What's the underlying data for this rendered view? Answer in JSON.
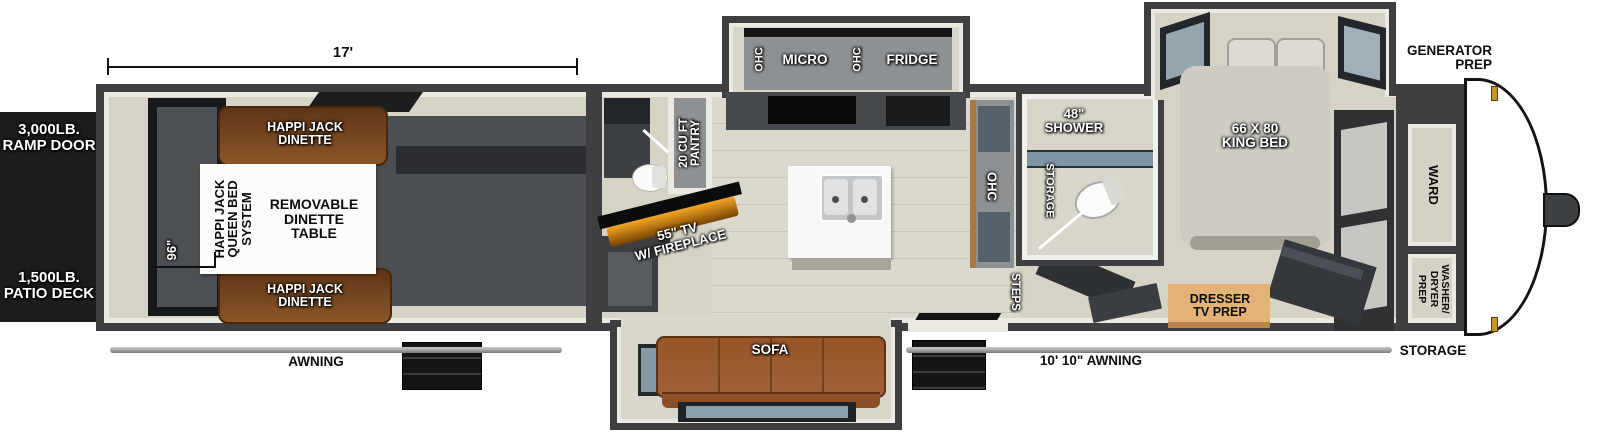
{
  "title": "Fifth Wheel Toy Hauler Floorplan",
  "colors": {
    "wall": "#3f3f41",
    "lining": "#ebe9e1",
    "floor": "#d6d2c5",
    "garage_floor": "#4b4e52",
    "black_panel": "#1d1d1d",
    "dinette_brown": "#7c4a22",
    "sofa_brown": "#a0613a",
    "cabinet_gray": "#8e9193",
    "wood_trim": "#a97b42",
    "dresser_tan": "#e3b277",
    "bed_gray": "#cecbc3",
    "shower_glass": "#7d95a3",
    "label_black": "#0d0d0d",
    "fireplace_glow": "#f5a623",
    "awning_gray": "#a8a8a8",
    "clearance_light": "#c9962b"
  },
  "exterior": {
    "ramp_door": "3,000LB.\nRAMP DOOR",
    "patio_deck": "1,500LB.\nPATIO DECK",
    "awning_left": "AWNING",
    "awning_right": "10' 10\" AWNING",
    "generator_prep": "GENERATOR\nPREP",
    "storage_front": "STORAGE"
  },
  "dimensions": {
    "garage_length": "17'",
    "garage_width": "96\""
  },
  "garage": {
    "dinette_top": "HAPPI JACK\nDINETTE",
    "dinette_bottom": "HAPPI JACK\nDINETTE",
    "queen_bed_system": "HAPPI JACK\nQUEEN BED\nSYSTEM",
    "dinette_table": "REMOVABLE\nDINETTE\nTABLE"
  },
  "living": {
    "pantry": "20 CU FT\nPANTRY",
    "tv_fireplace": "55\" TV\nW/ FIREPLACE",
    "ohc_left": "OHC",
    "micro": "MICRO",
    "ohc_mid": "OHC",
    "fridge": "FRIDGE",
    "sofa": "SOFA",
    "ohc_island": "OHC",
    "steps": "STEPS"
  },
  "bathroom": {
    "shower": "48\"\nSHOWER",
    "storage": "STORAGE"
  },
  "bedroom": {
    "king_bed": "66 X 80\nKING BED",
    "dresser": "DRESSER\nTV PREP",
    "ward": "WARD",
    "washer_dryer": "WASHER/\nDRYER\nPREP"
  }
}
